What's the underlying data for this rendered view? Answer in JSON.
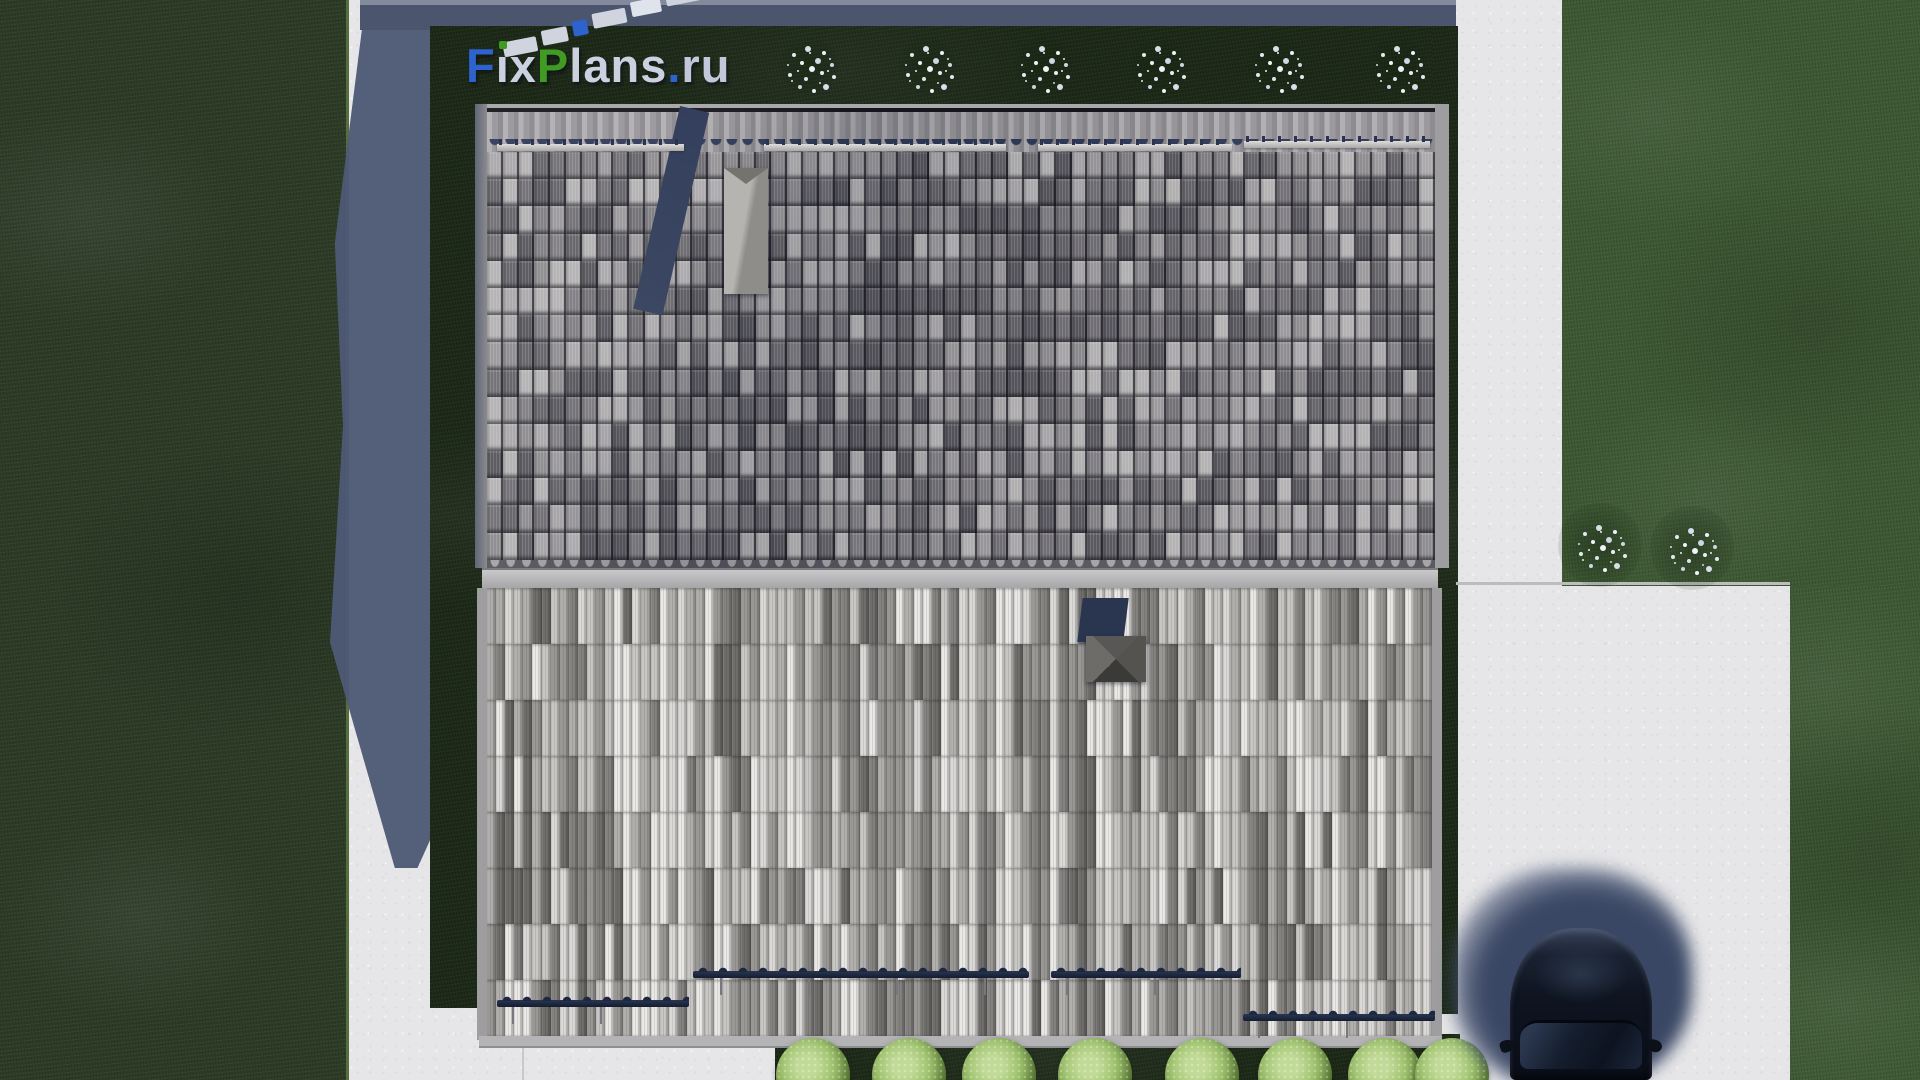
{
  "watermark": {
    "site_text": "FixPlans.ru",
    "letters": [
      {
        "ch": "F",
        "color": "#2e62cc"
      },
      {
        "ch": "i",
        "color": "#ccd1e0",
        "dot": "#3f9b22"
      },
      {
        "ch": "x",
        "color": "#ccd1e0"
      },
      {
        "ch": "P",
        "color": "#3f9b22"
      },
      {
        "ch": "l",
        "color": "#ccd1e0"
      },
      {
        "ch": "a",
        "color": "#ccd1e0"
      },
      {
        "ch": "n",
        "color": "#ccd1e0"
      },
      {
        "ch": "s",
        "color": "#ccd1e0"
      },
      {
        "ch": ".",
        "color": "#2e62cc"
      },
      {
        "ch": "r",
        "color": "#c2c8da"
      },
      {
        "ch": "u",
        "color": "#c2c8da"
      }
    ],
    "fragments": [
      {
        "x": 0,
        "y": 24,
        "w": 34,
        "color": "#cfd4df"
      },
      {
        "x": 40,
        "y": 20,
        "w": 26,
        "color": "#cfd4df"
      },
      {
        "x": 72,
        "y": 17,
        "w": 15,
        "color": "#2e62cc"
      },
      {
        "x": 93,
        "y": 13,
        "w": 34,
        "color": "#cfd4df"
      },
      {
        "x": 133,
        "y": 9,
        "w": 30,
        "color": "#dfe3ec"
      },
      {
        "x": 169,
        "y": 5,
        "w": 34,
        "color": "#cfd4df"
      },
      {
        "x": 209,
        "y": 1,
        "w": 26,
        "color": "#3f9b22"
      }
    ]
  },
  "palette": {
    "concrete": "#e6e6e8",
    "lawn_left": "#2c3b26",
    "lawn_right": "#3e5833",
    "garden": "#1d2a18",
    "cast_shadow": "#4e5a76",
    "upper_roof_tiles": [
      "#a8a6a8",
      "#999799",
      "#8b898c",
      "#7d7b7f",
      "#6f6d72",
      "#616065",
      "#55545a",
      "#b2b0b1"
    ],
    "lower_roof_stripes": [
      "#eceae7",
      "#dddbd8",
      "#cac8c5",
      "#b3b1ad",
      "#9b9995",
      "#858380",
      "#706e6b"
    ],
    "ridge_shadow": "#2e3a57",
    "rail_upper": "#d0cfcd",
    "rail_lower": "#1d2740",
    "chimney": "#b3b1ad",
    "chimney_shadow": "#333f5c",
    "vent_cap": "#4a4a46",
    "bush_flower_white": "#eef1f6",
    "bush_green": "#a5c775",
    "car_body": "#0e1420",
    "car_glass": "#151e2e"
  },
  "scene_objects": {
    "upper_roof_grid": {
      "cols": 60,
      "rows": 15,
      "seed": 7
    },
    "lower_roof_grid": {
      "cols": 104,
      "rows": 8,
      "seed": 21,
      "streak_chance": 0.45
    },
    "rails_upper": [
      {
        "x": 497,
        "y": 144,
        "w": 187
      },
      {
        "x": 764,
        "y": 144,
        "w": 242
      },
      {
        "x": 1038,
        "y": 144,
        "w": 194
      },
      {
        "x": 1244,
        "y": 141,
        "w": 186
      }
    ],
    "rails_lower": [
      {
        "x": 497,
        "y": 1000,
        "w": 192
      },
      {
        "x": 693,
        "y": 971,
        "w": 336
      },
      {
        "x": 1051,
        "y": 971,
        "w": 190
      },
      {
        "x": 1243,
        "y": 1014,
        "w": 192
      }
    ],
    "bushes_top": {
      "cy": 66,
      "d": 58,
      "cx": [
        809,
        927,
        1043,
        1159,
        1277,
        1398
      ]
    },
    "bushes_right": [
      {
        "cx": 1600,
        "cy": 545,
        "d": 84
      },
      {
        "cx": 1692,
        "cy": 548,
        "d": 84
      }
    ],
    "bushes_bottom": {
      "cy": 1075,
      "d": 74,
      "cx": [
        813,
        909,
        999,
        1095,
        1202,
        1295,
        1385,
        1452
      ]
    }
  }
}
